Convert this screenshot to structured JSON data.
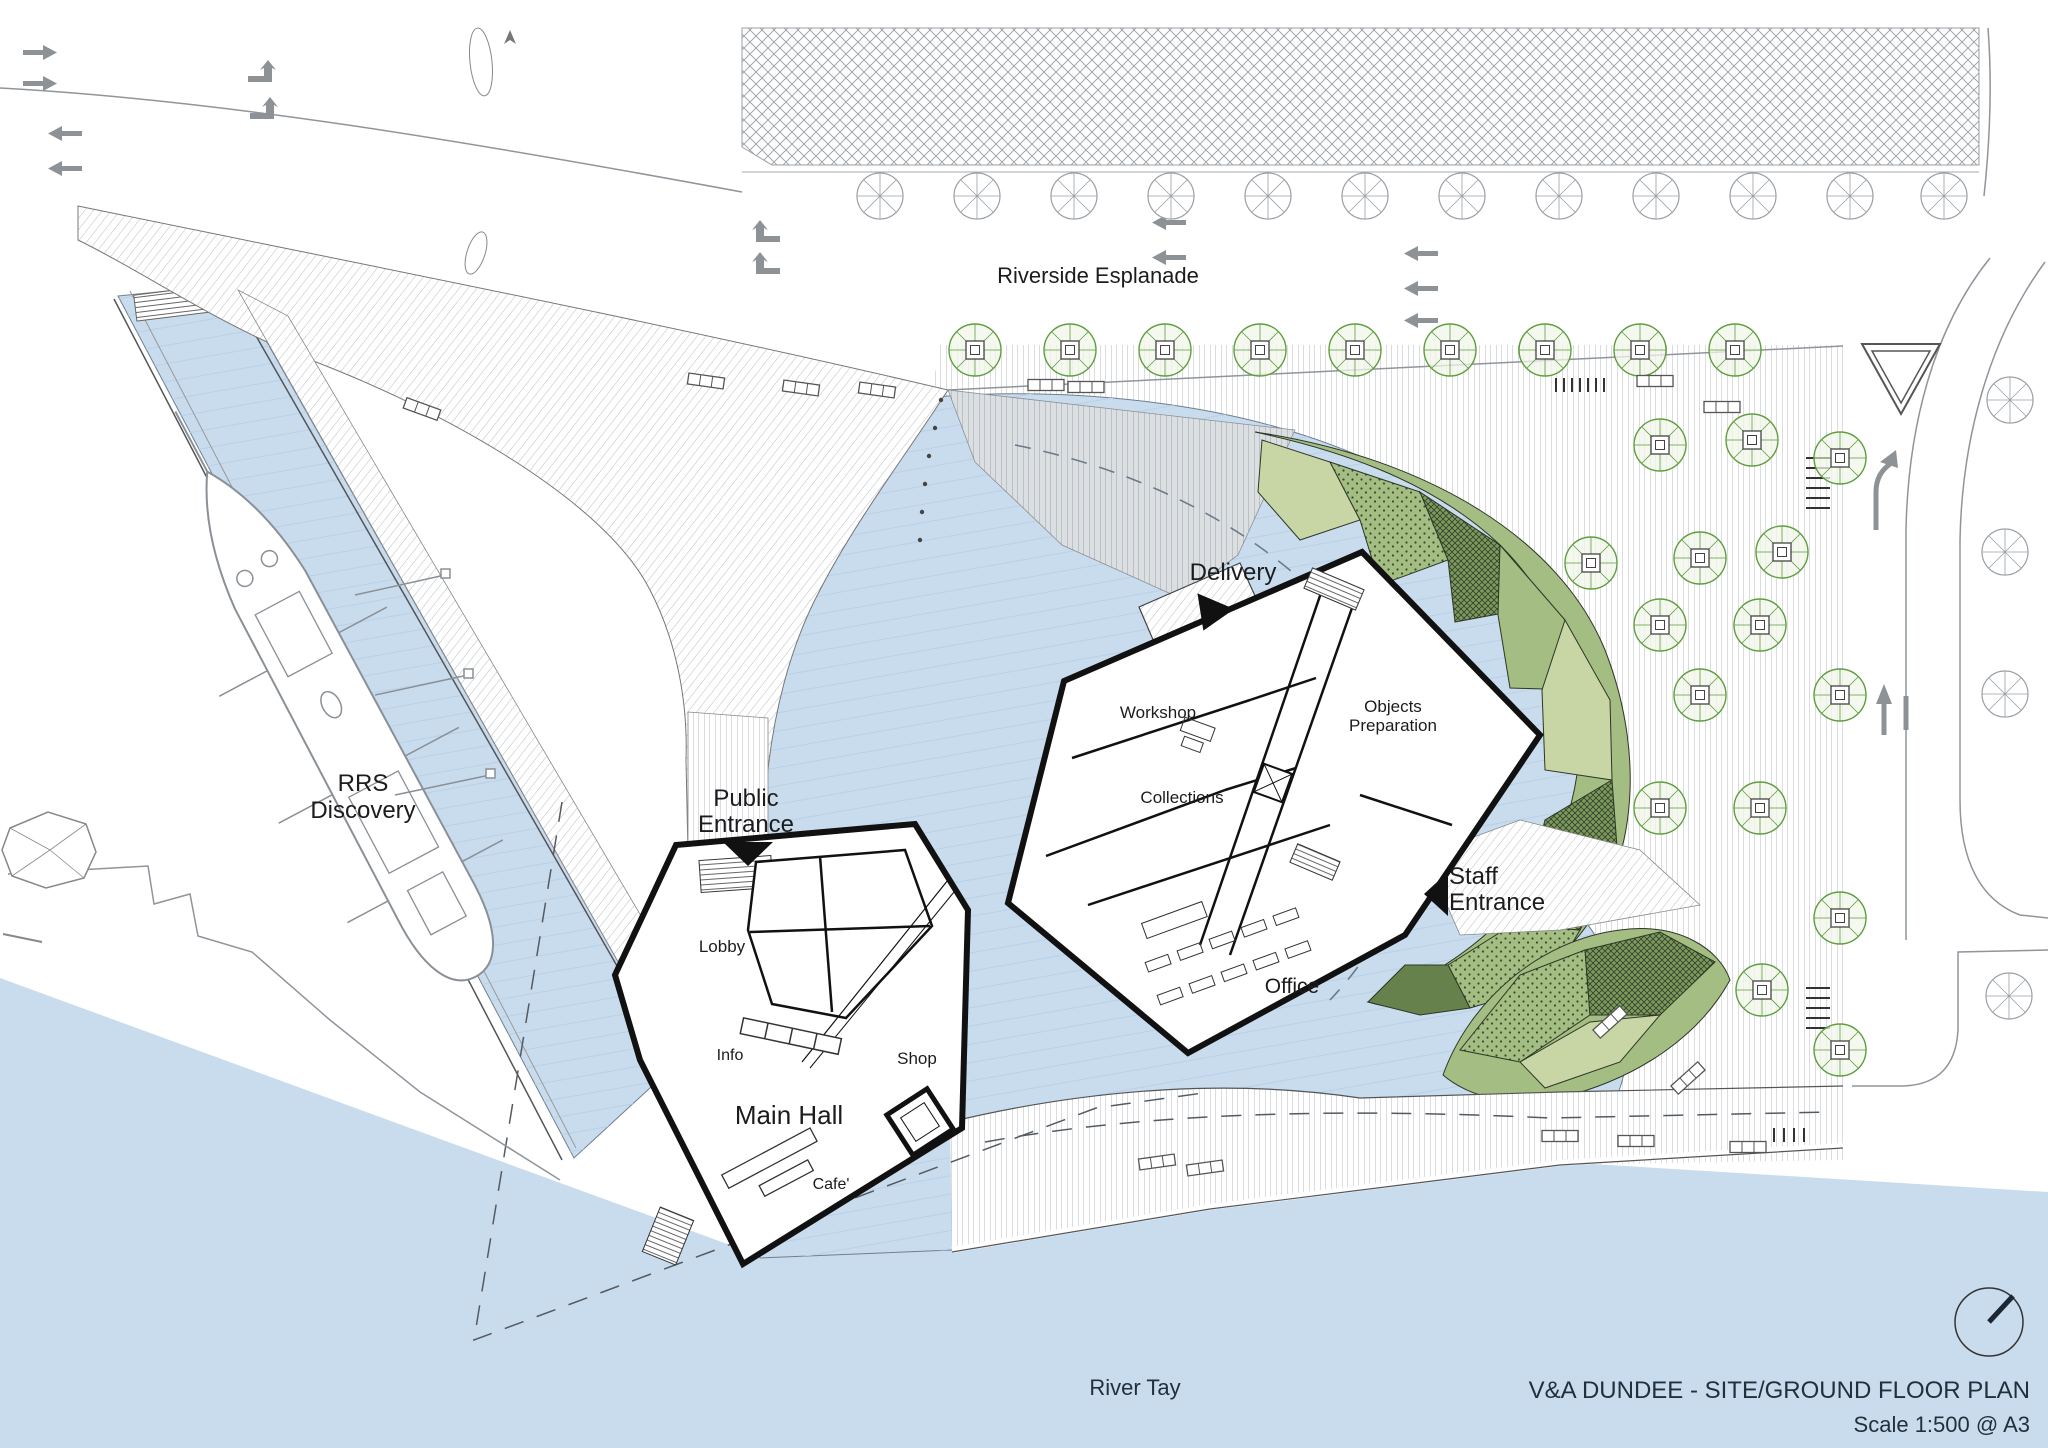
{
  "title_block": {
    "title": "V&A DUNDEE - SITE/GROUND FLOOR PLAN",
    "scale_note": "Scale 1:500 @ A3"
  },
  "labels": {
    "riverside_esplanade": "Riverside Esplanade",
    "river_tay": "River Tay",
    "rrs_discovery": {
      "line1": "RRS",
      "line2": "Discovery"
    },
    "public_entrance": {
      "line1": "Public",
      "line2": "Entrance"
    },
    "delivery": "Delivery",
    "staff_entrance": {
      "line1": "Staff",
      "line2": "Entrance"
    }
  },
  "rooms": {
    "workshop": "Workshop",
    "objects_preparation": {
      "line1": "Objects",
      "line2": "Preparation"
    },
    "collections": "Collections",
    "office": "Office",
    "lobby": "Lobby",
    "info": "Info",
    "shop": "Shop",
    "main_hall": "Main Hall",
    "cafe": "Cafe'"
  },
  "colors": {
    "water": "#c9dcee",
    "paving_line": "#b6bac0",
    "hatch_line": "#b9bdc1",
    "green_mid": "#a3bd82",
    "green_light": "#c8d6a5",
    "green_dark": "#7d9a5d",
    "green_deep": "#66814c",
    "tree_stroke": "#5f9e3e",
    "arrow_gray": "#8d9296",
    "wall_black": "#111111",
    "text_dark": "#1c1c1e"
  },
  "icons": {
    "north_arrow": "north-arrow-icon",
    "tree_green": "tree-icon",
    "tree_gray": "tree-gray-icon",
    "bench": "bench-icon",
    "entrance_arrow": "entrance-arrow-icon",
    "give_way": "give-way-triangle-icon"
  }
}
